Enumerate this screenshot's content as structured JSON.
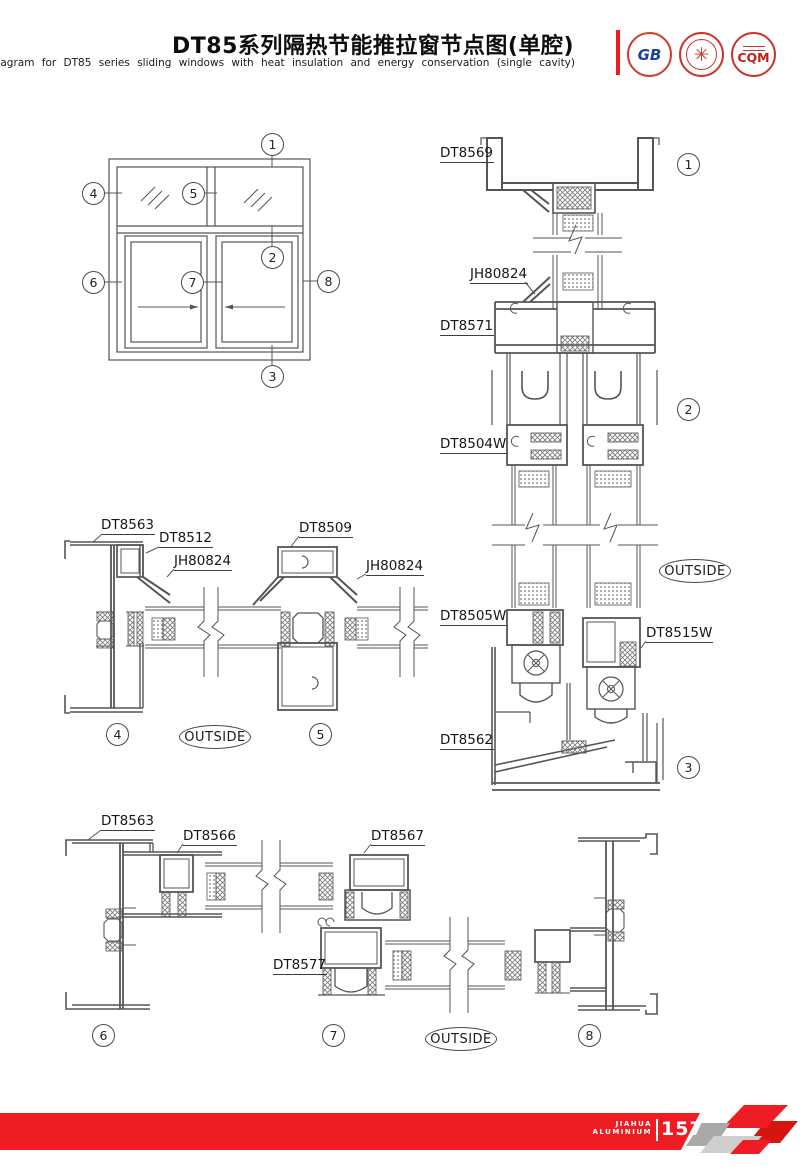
{
  "colors": {
    "accent_red": "#ee1c23",
    "line_gray": "#555555"
  },
  "header": {
    "title_cn": "DT85系列隔热节能推拉窗节点图(单腔)",
    "title_en": "Node diagram for DT85 series sliding windows with heat insulation and energy conservation (single cavity)",
    "logos": [
      {
        "id": "gb-certification",
        "text": "GB"
      },
      {
        "id": "quality-cert",
        "text": "✳"
      },
      {
        "id": "cqm",
        "text": "CQM"
      }
    ]
  },
  "elevation": {
    "callouts": {
      "c1": "1",
      "c2": "2",
      "c3": "3",
      "c4": "4",
      "c5": "5",
      "c6": "6",
      "c7": "7",
      "c8": "8"
    }
  },
  "section_vertical": {
    "label_head": "DT8569",
    "label_gasket": "JH80824",
    "label_transom": "DT8571",
    "label_sash_top": "DT8504W",
    "label_sash_bottom_left": "DT8505W",
    "label_sash_bottom_right": "DT8515W",
    "label_sill": "DT8562",
    "outside": "OUTSIDE",
    "callout_top": "1",
    "callout_mid": "2",
    "callout_bottom": "3"
  },
  "section_mid": {
    "label_frame": "DT8563",
    "label_sash": "DT8512",
    "label_gasket_left": "JH80824",
    "label_stile": "DT8509",
    "label_gasket_right": "JH80824",
    "outside": "OUTSIDE",
    "callout_left": "4",
    "callout_right": "5"
  },
  "section_bottom": {
    "label_frame": "DT8563",
    "label_sash_left": "DT8566",
    "label_sash_right": "DT8567",
    "label_sash_lower": "DT8577",
    "outside": "OUTSIDE",
    "callout_left": "6",
    "callout_mid": "7",
    "callout_right": "8"
  },
  "footer": {
    "brand_line1": "JIAHUA",
    "brand_line2": "ALUMINIUM",
    "page_number": "157"
  }
}
